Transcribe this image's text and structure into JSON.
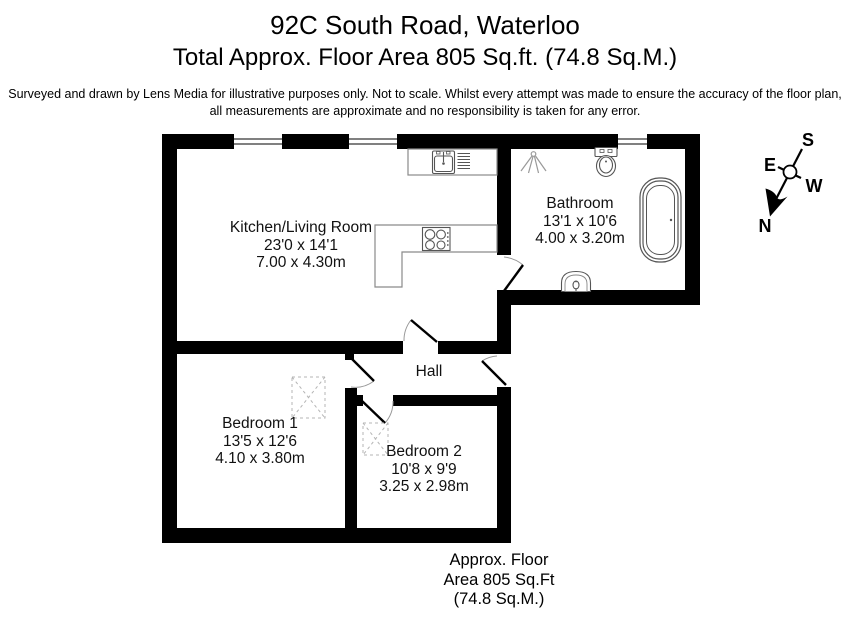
{
  "header": {
    "title": "92C South Road, Waterloo",
    "subtitle": "Total Approx. Floor Area 805 Sq.ft. (74.8 Sq.M.)",
    "disclaimer_line1": "Surveyed and drawn by Lens Media for illustrative purposes only. Not to scale. Whilst every attempt was made to ensure the accuracy of the floor plan,",
    "disclaimer_line2": "all measurements are approximate and no responsibility is taken for any error."
  },
  "rooms": {
    "kitchen_living": {
      "name": "Kitchen/Living Room",
      "dims_imperial": "23'0 x 14'1",
      "dims_metric": "7.00 x 4.30m"
    },
    "bathroom": {
      "name": "Bathroom",
      "dims_imperial": "13'1 x 10'6",
      "dims_metric": "4.00 x 3.20m"
    },
    "hall": {
      "name": "Hall"
    },
    "bedroom1": {
      "name": "Bedroom 1",
      "dims_imperial": "13'5 x 12'6",
      "dims_metric": "4.10 x 3.80m"
    },
    "bedroom2": {
      "name": "Bedroom 2",
      "dims_imperial": "10'8 x 9'9",
      "dims_metric": "3.25 x 2.98m"
    }
  },
  "compass": {
    "north": "N",
    "south": "S",
    "east": "E",
    "west": "W"
  },
  "footer": {
    "line1": "Approx. Floor",
    "line2": "Area 805 Sq.Ft",
    "line3": "(74.8 Sq.M.)"
  },
  "icons": [
    "compass-icon",
    "bathtub-icon",
    "toilet-icon",
    "basin-icon",
    "shower-icon",
    "sink-icon",
    "hob-icon",
    "hatch-icon"
  ],
  "colors": {
    "wall": "#000000",
    "background": "#ffffff",
    "fixture_outline": "#555555",
    "counter_outline": "#8a8a8a",
    "hatch": "#b5b5b5",
    "door_arc": "#999999"
  }
}
